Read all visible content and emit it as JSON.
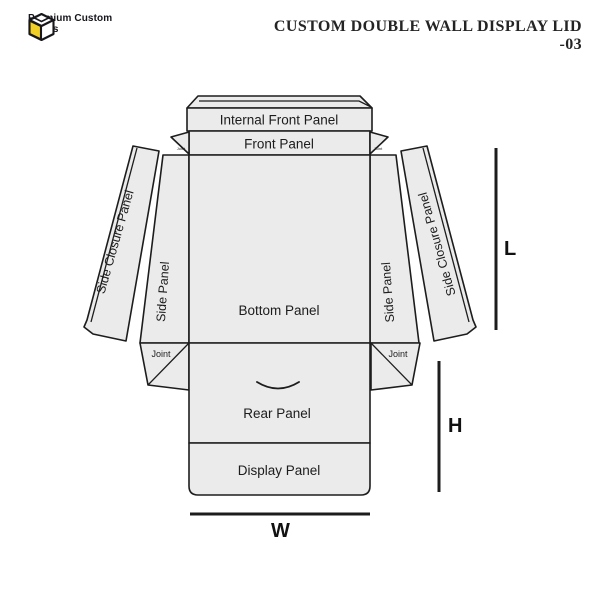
{
  "header": {
    "logo": {
      "line1": "Premium Custom",
      "line2": "Boxes"
    },
    "title": {
      "line1": "CUSTOM DOUBLE WALL DISPLAY LID",
      "line2": "-03"
    }
  },
  "diagram": {
    "panels": {
      "internal_front": "Internal Front Panel",
      "front": "Front Panel",
      "bottom": "Bottom Panel",
      "rear": "Rear Panel",
      "display": "Display Panel",
      "side_left": "Side Panel",
      "side_right": "Side Panel",
      "side_closure_left": "Side Closure Panel",
      "side_closure_right": "Side Closure Panel",
      "joint_bottom_left": "Joint",
      "joint_bottom_right": "Joint",
      "joint_top_left": "Joint",
      "joint_top_right": "Joint"
    },
    "dimensions": {
      "length": "L",
      "height": "H",
      "width": "W"
    }
  },
  "colors": {
    "panel_fill": "#ebebeb",
    "line": "#1d1d1d",
    "logo_yellow": "#f2cf27",
    "text_dark": "#1c1c1c"
  }
}
